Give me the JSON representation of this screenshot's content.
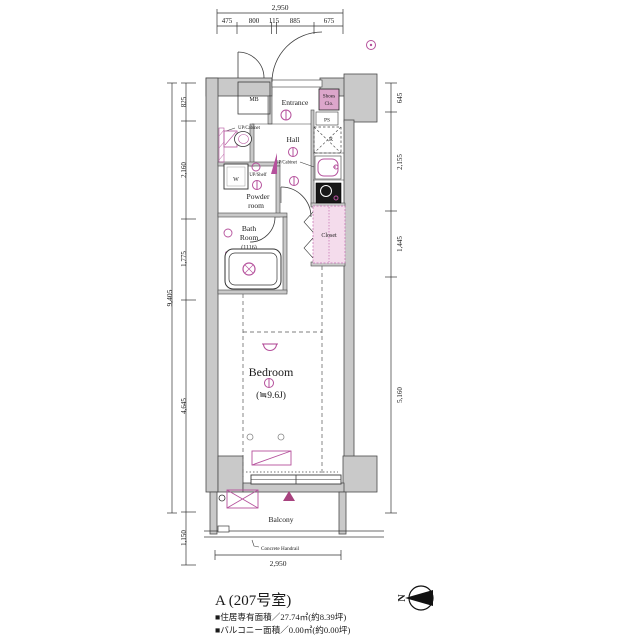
{
  "colors": {
    "wall_fill": "#c9c9c9",
    "line": "#3c3c3c",
    "accent_pink": "#b5519c",
    "closet_fill": "#f4dcec",
    "shoes_fill": "#dca6cb",
    "stove_fill": "#181818"
  },
  "dims": {
    "top_total": "2,950",
    "top_segments": [
      "475",
      "800",
      "115",
      "885",
      "675"
    ],
    "left_total": "9,405",
    "left_segments": [
      "825",
      "2,160",
      "1,775",
      "4,645"
    ],
    "left_balcony": "1,150",
    "right_segments": [
      "645",
      "2,155",
      "1,445",
      "5,160"
    ],
    "bottom_total": "2,950"
  },
  "rooms": {
    "mb": "MB",
    "entrance": "Entrance",
    "shoes1": "Shoes",
    "shoes2": "Clo.",
    "ps": "PS",
    "fridge": "R",
    "hall": "Hall",
    "up_cabinet_a": "UP/Cabinet",
    "up_cabinet_b": "UP/Cabinet",
    "washer": "W",
    "up_shelf": "UP/Shelf",
    "powder1": "Powder",
    "powder2": "room",
    "bath1": "Bath",
    "bath2": "Room",
    "bath_size": "(1116)",
    "closet": "Closet",
    "bedroom": "Bedroom",
    "bedroom_size": "(≒9.6J)",
    "balcony": "Balcony",
    "handrail": "Concrete Handrail"
  },
  "footer": {
    "unit": "A (207号室)",
    "area_living": "■住居専有面積／27.74㎡(約8.39坪)",
    "area_balcony": "■バルコニー面積／0.00㎡(約0.00坪)"
  },
  "compass": {
    "north": "N"
  }
}
